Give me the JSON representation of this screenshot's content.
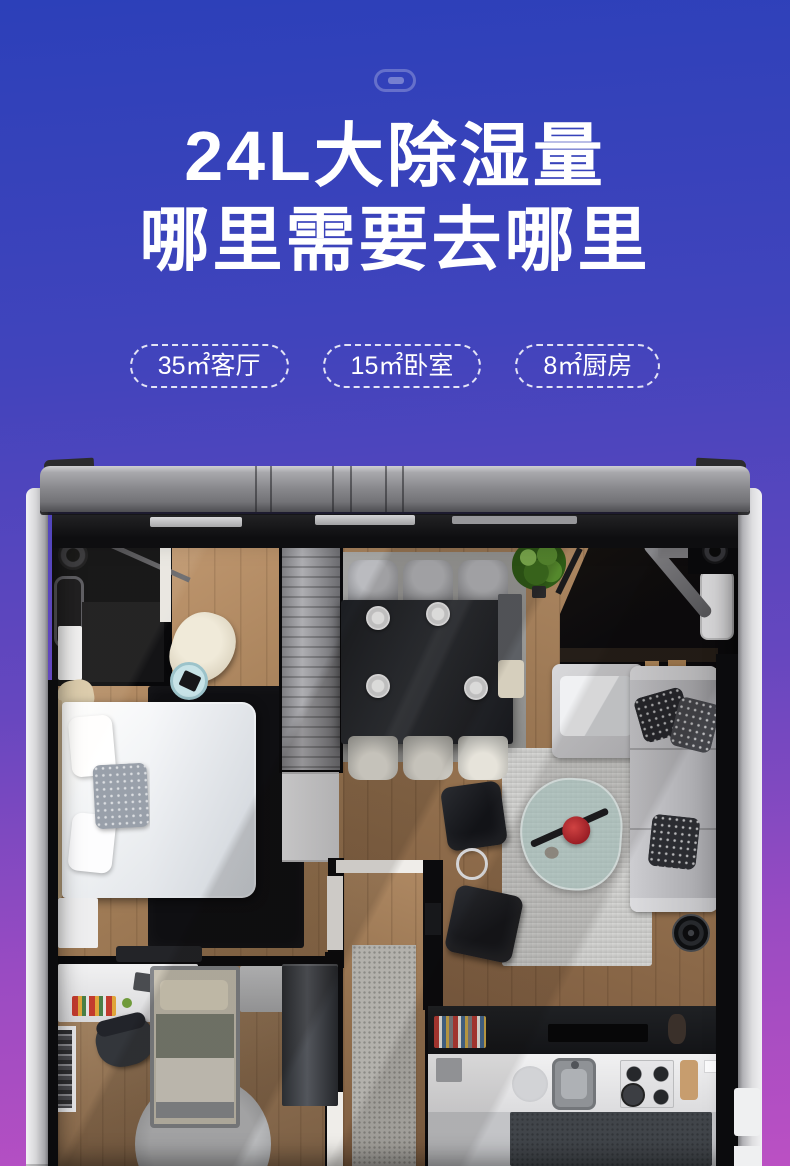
{
  "header": {
    "indicator_icon": "capsule-icon",
    "title_line1": "24L大除湿量",
    "title_line2": "哪里需要去哪里",
    "badges": [
      {
        "label": "35㎡客厅"
      },
      {
        "label": "15㎡卧室"
      },
      {
        "label": "8㎡厨房"
      }
    ]
  },
  "floorplan": {
    "rooms": [
      "master-bedroom",
      "dining-area",
      "living-room",
      "hallway",
      "study-bedroom",
      "kitchen"
    ]
  },
  "colors": {
    "bg_top": "#2c40b9",
    "bg_mid": "#6647bf",
    "bg_bottom": "#bb50c3",
    "title_text": "#ffffff",
    "badge_border": "rgba(255,255,255,0.85)",
    "device_metal": "#8b8b8f",
    "device_edge_light": "#e6e6e8",
    "frame_black": "#0b0b0d",
    "wood_warm": "#a9845e",
    "plant_green": "#4f8429"
  }
}
